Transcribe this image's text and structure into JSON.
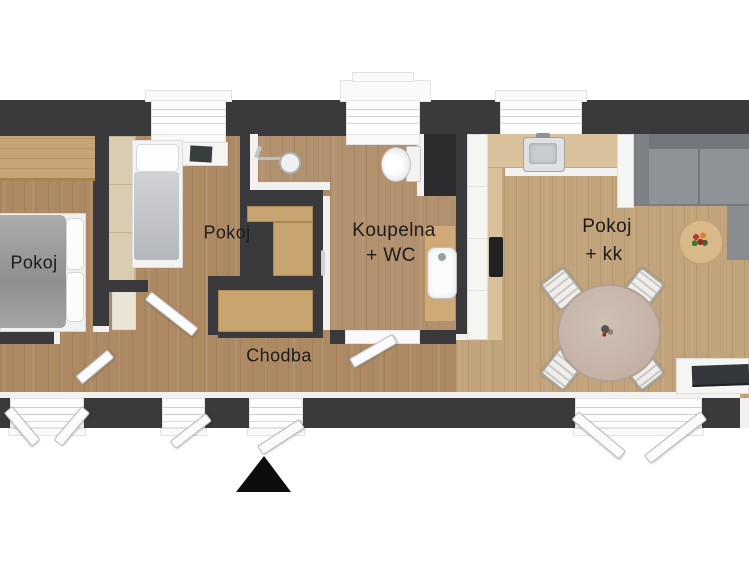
{
  "plan_title": "apartment-floor-plan",
  "rooms": {
    "bedroom_left": {
      "label": "Pokoj"
    },
    "bedroom_middle": {
      "label": "Pokoj"
    },
    "bathroom": {
      "label_line1": "Koupelna",
      "label_line2": "+ WC"
    },
    "hallway": {
      "label": "Chodba"
    },
    "living_kitchen": {
      "label_line1": "Pokoj",
      "label_line2": "+ kk"
    }
  },
  "colors": {
    "background": "#ffffff",
    "wall_dark": "#3a393b",
    "floor_bedrooms": "#ad8a64",
    "floor_bathroom": "#b2916f",
    "floor_living": "#c1a47b",
    "cabinet_beige": "#c8a471",
    "wardrobe_beige": "#d9ccb1",
    "counter_beige": "#d9c19b",
    "sofa_gray": "#8f9297",
    "bed_gray": "#9a9a9a",
    "entrance_marker": "#0d0d0d"
  }
}
